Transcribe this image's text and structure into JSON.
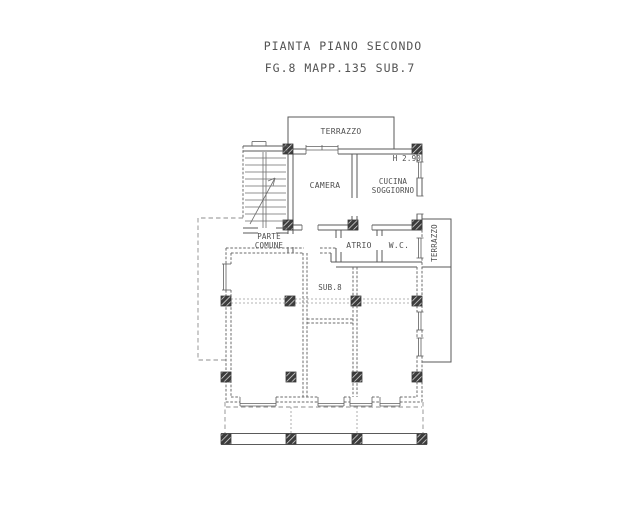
{
  "title": {
    "line1": "PIANTA PIANO SECONDO",
    "line2": "FG.8 MAPP.135 SUB.7"
  },
  "plan": {
    "rooms": {
      "terrace_top": "TERRAZZO",
      "bedroom": "CAMERA",
      "kitchen_line1": "CUCINA",
      "kitchen_line2": "SOGGIORNO",
      "common_line1": "PARTE",
      "common_line2": "COMUNE",
      "hall": "ATRIO",
      "wc": "W.C.",
      "terrace_right": "TERRAZZO"
    },
    "annotations": {
      "ceiling_height": "H 2.90",
      "unit_label": "SUB.8"
    },
    "colors": {
      "paper": "#ffffff",
      "ink": "#4f4f4f",
      "wall": "#5a5a5a",
      "boundary": "#8d8d8d",
      "pillar": "#3a3a3a"
    }
  }
}
